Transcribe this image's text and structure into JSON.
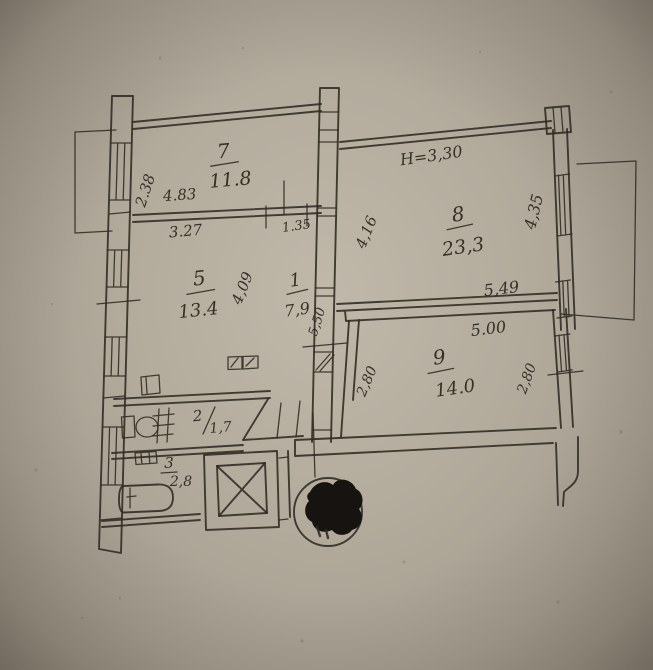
{
  "colors": {
    "paper": "#b3ab9c",
    "ink": "#2f2a22"
  },
  "annotations": {
    "ceiling_height": "Н=3,30"
  },
  "rooms": {
    "r7": {
      "number": "7",
      "area": "11.8"
    },
    "r8": {
      "number": "8",
      "area": "23,3"
    },
    "r5": {
      "number": "5",
      "area": "13.4"
    },
    "r1": {
      "number": "1",
      "area": "7,9"
    },
    "r9": {
      "number": "9",
      "area": "14.0"
    },
    "r2": {
      "number": "2",
      "area": "1,7"
    },
    "r3": {
      "number": "3",
      "area": "2,8"
    }
  },
  "dimensions": {
    "room7_left": "2.38",
    "room7_width": "4.83",
    "room5_width": "3.27",
    "hall_width": "1.35",
    "room8_left": "4,16",
    "room8_right": "4,35",
    "room8_width": "5,49",
    "room9_width": "5.00",
    "room9_left": "2,80",
    "room9_right": "2,80",
    "room5_height": "4,09",
    "hall_height": "5,50"
  }
}
